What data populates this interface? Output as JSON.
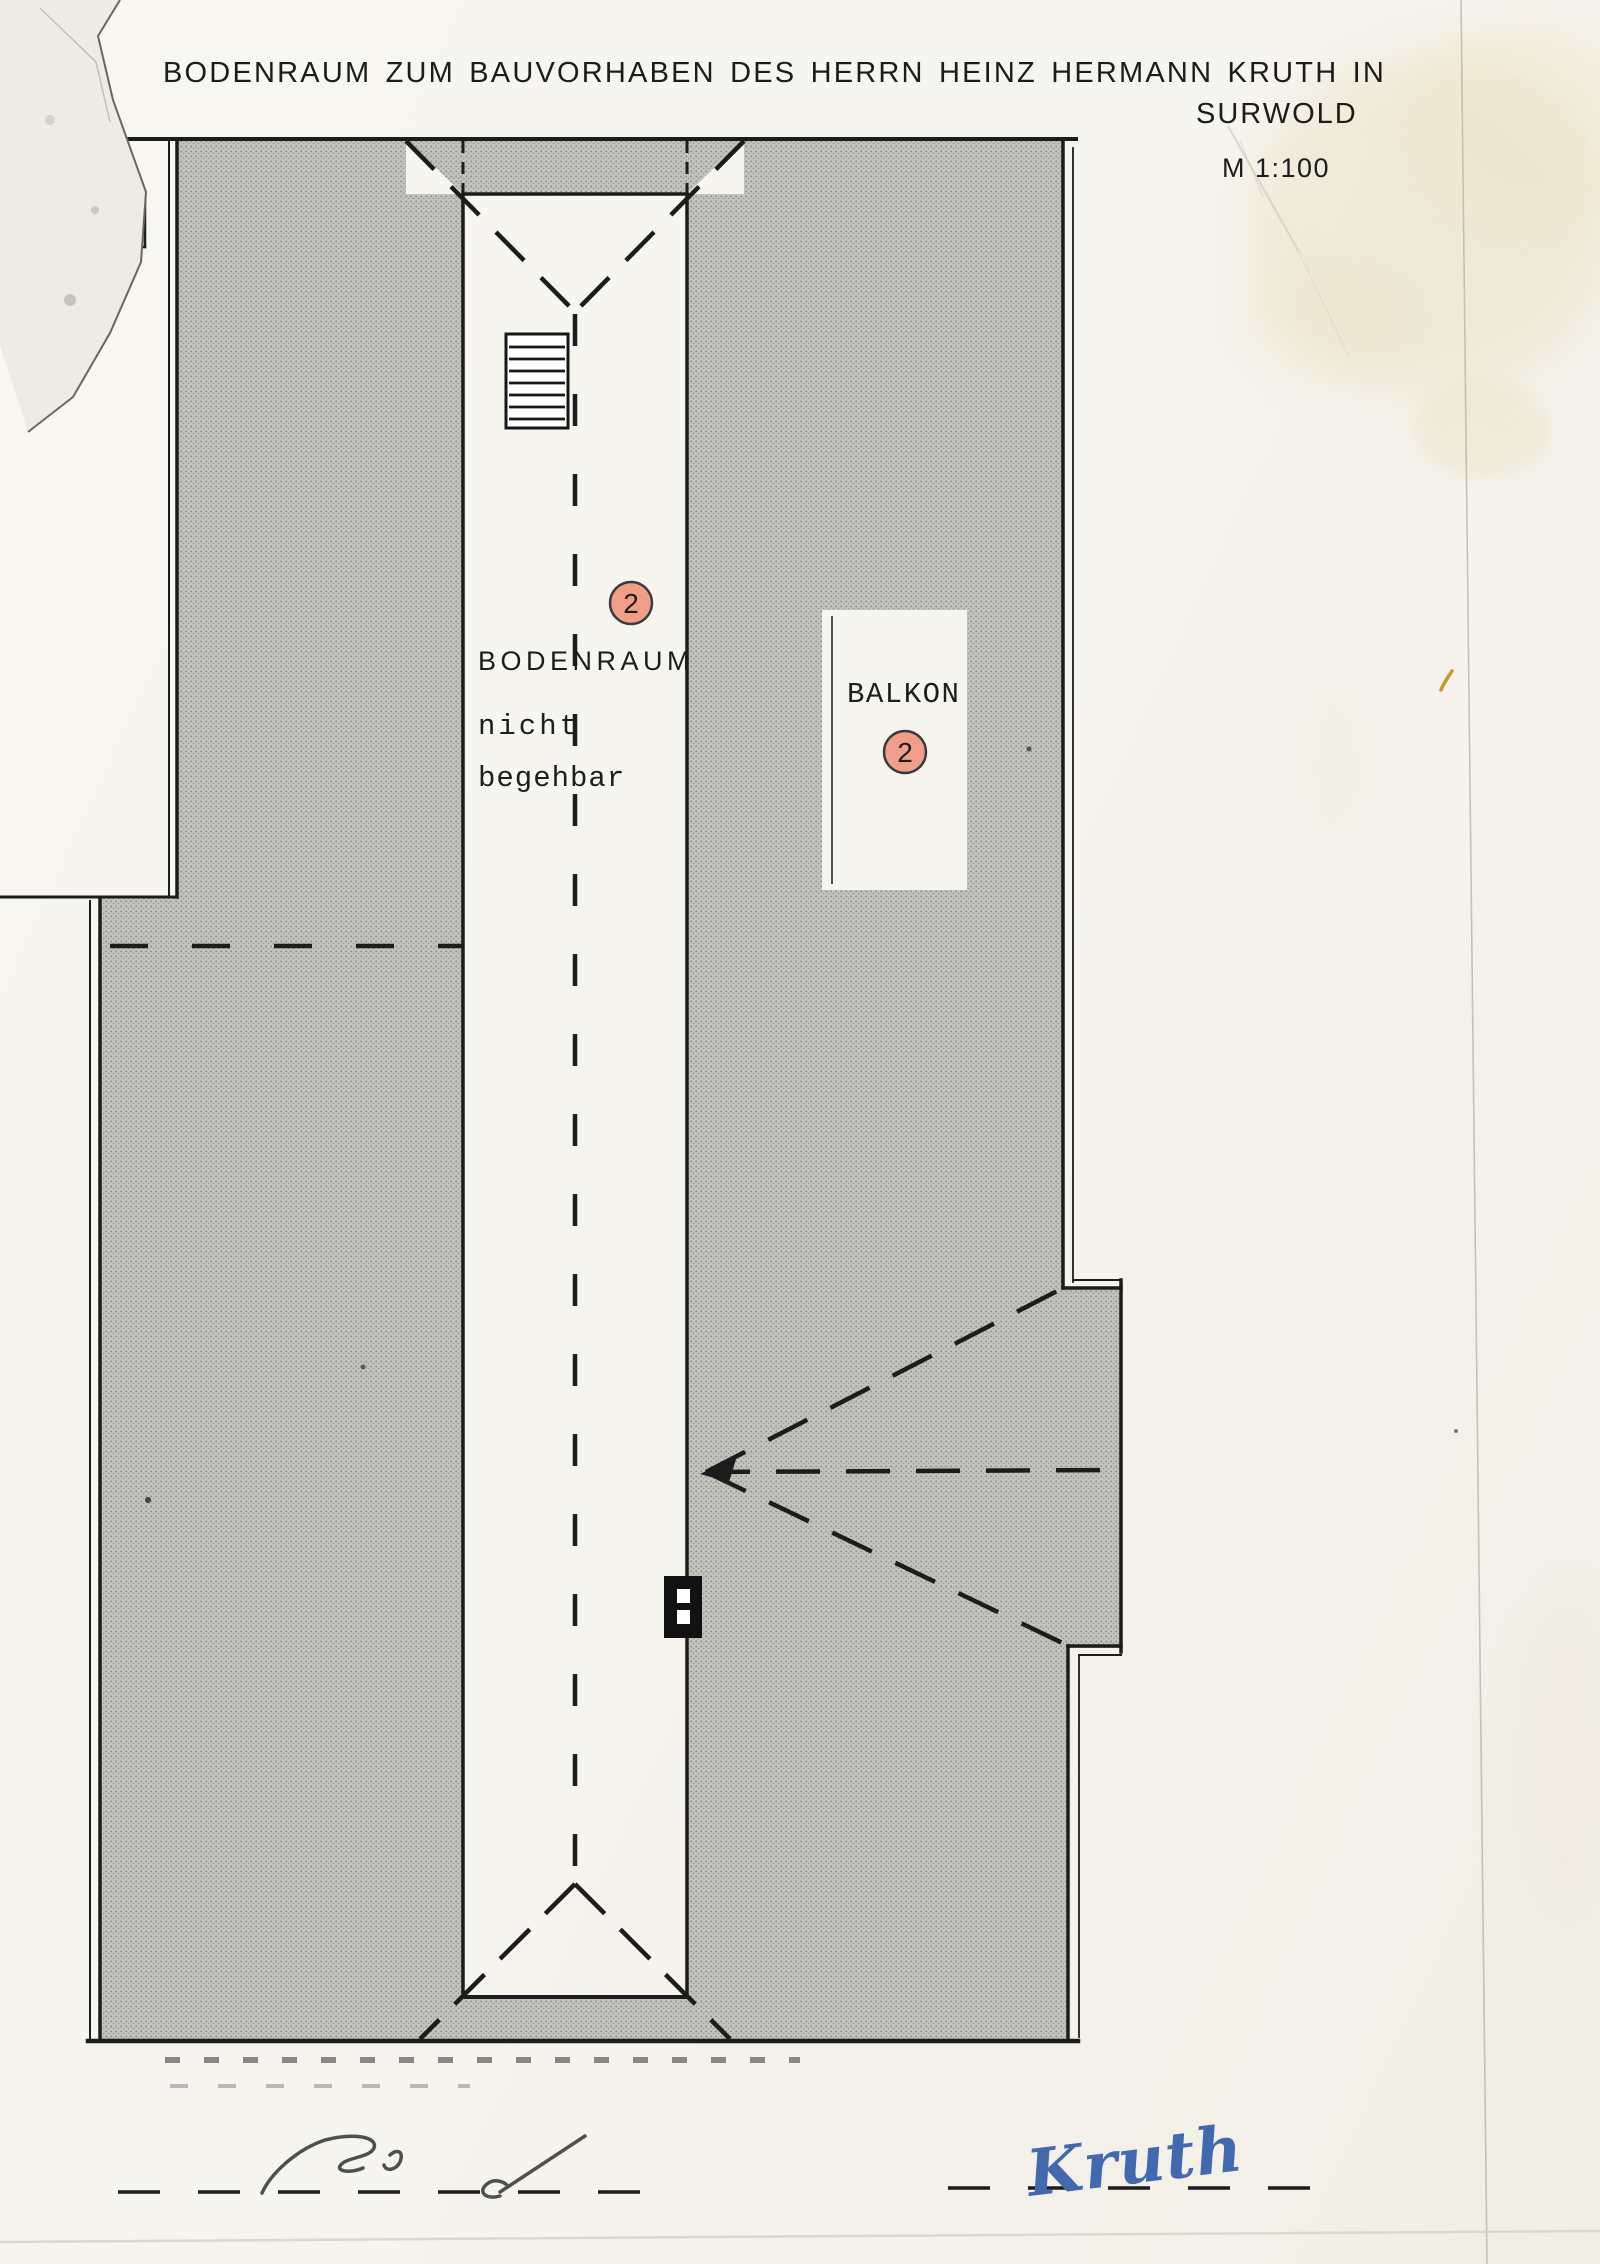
{
  "title": {
    "line1": "BODENRAUM ZUM BAUVORHABEN DES HERRN HEINZ HERMANN KRUTH IN",
    "place": "SURWOLD",
    "scale": "M 1:100"
  },
  "plan": {
    "attic_label": {
      "name": "BODENRAUM",
      "note_line1": "nicht",
      "note_line2": "begehbar",
      "marker": "2"
    },
    "balcony": {
      "label": "BALKON",
      "marker": "2"
    }
  },
  "signatures": {
    "owner_signature": "Kruth"
  },
  "colors": {
    "paper": "#f6f4ee",
    "roof_gray": "#c1c1bc",
    "line_ink": "#1c1c1c",
    "marker_fill": "#f19e89",
    "marker_stroke": "#3a3a3a",
    "signature_blue": "#4268ae",
    "pencil_gray": "#4f4f4c",
    "stain_yellow": "#e9dfc2"
  }
}
